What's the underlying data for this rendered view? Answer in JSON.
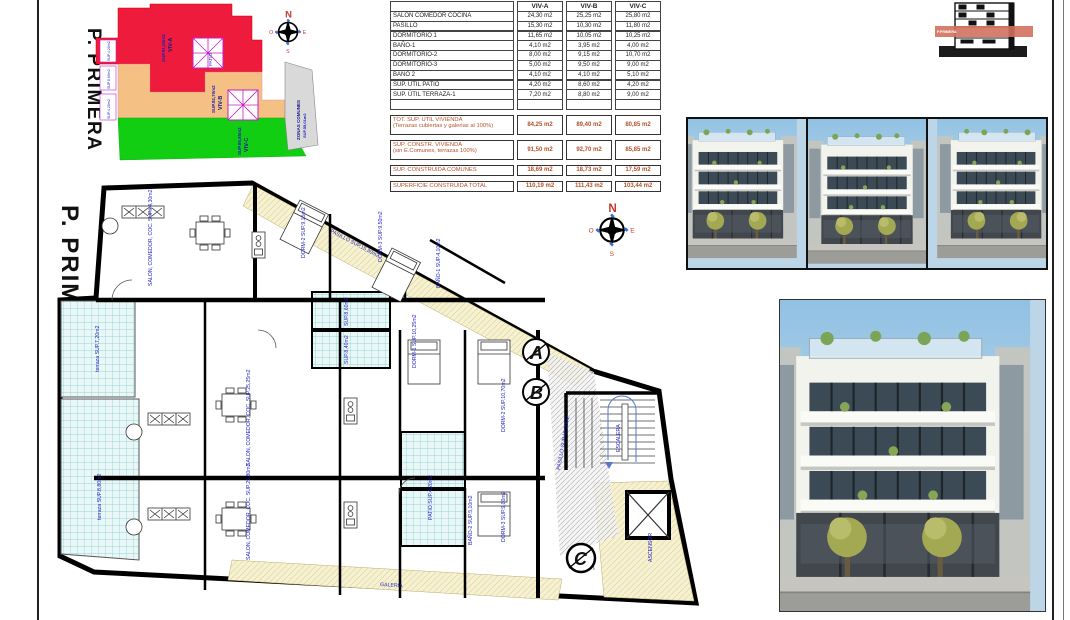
{
  "sheet": {
    "floor_title": "P. PRIMERA"
  },
  "site_plan": {
    "title": "P. PRIMERA",
    "zones": [
      {
        "name": "VIV-A",
        "area": "SUP.91,50m2",
        "color": "#ee1b3d"
      },
      {
        "name": "VIV-B",
        "area": "SUP.92,70m2",
        "color": "#f4c083"
      },
      {
        "name": "VIV-C",
        "area": "SUP.85,85m2",
        "color": "#12ce12"
      },
      {
        "name": "ZONAS COMUNES",
        "area": "SUP.55,01m2",
        "color": "#d9d9d9"
      }
    ],
    "edge_labels": [
      "SUP.4,20m2",
      "SUP.8,60m2",
      "SUP.4,20m2"
    ],
    "patio_label": "PATIO"
  },
  "compass": {
    "n": "N",
    "s": "S",
    "e": "E",
    "w": "O"
  },
  "areas_table": {
    "columns": [
      "VIV-A",
      "VIV-B",
      "VIV-C"
    ],
    "rows": [
      {
        "label": "SALON COMEDOR COCINA",
        "a": "24,30 m2",
        "b": "25,25 m2",
        "c": "25,80 m2"
      },
      {
        "label": "PASILLO",
        "a": "15,30 m2",
        "b": "10,30 m2",
        "c": "11,80 m2"
      },
      {
        "label": "DORMITORIO 1",
        "a": "11,65 m2",
        "b": "10,05 m2",
        "c": "10,25 m2"
      },
      {
        "label": "BAÑO-1",
        "a": "4,10 m2",
        "b": "3,95 m2",
        "c": "4,00 m2"
      },
      {
        "label": "DORMITORIO-2",
        "a": "8,00 m2",
        "b": "9,15 m2",
        "c": "10,70 m2"
      },
      {
        "label": "DORMITORIO-3",
        "a": "5,00 m2",
        "b": "9,50 m2",
        "c": "9,00 m2"
      },
      {
        "label": "BAÑO 2",
        "a": "4,10 m2",
        "b": "4,10 m2",
        "c": "5,10 m2"
      },
      {
        "label": "SUP. ÚTIL PATIO",
        "a": "4,20 m2",
        "b": "8,60 m2",
        "c": "4,20 m2"
      },
      {
        "label": "SUP. ÚTIL TERRAZA-1",
        "a": "7,20 m2",
        "b": "8,80 m2",
        "c": "9,00 m2"
      }
    ],
    "summary": [
      {
        "label": "TOT. SUP. UTIL VIVIENDA",
        "sub": "(Terrazas cubiertas y galerias al 100%)",
        "a": "84,25 m2",
        "b": "89,40 m2",
        "c": "80,85 m2"
      },
      {
        "label": "SUP. CONSTR. VIVIENDA",
        "sub": "(sin E.Comunes, terrazas 100%)",
        "a": "91,50 m2",
        "b": "92,70 m2",
        "c": "85,85 m2"
      },
      {
        "label": "SUP. CONSTRUIDA COMUNES",
        "sub": "",
        "a": "18,69 m2",
        "b": "18,73 m2",
        "c": "17,59 m2"
      },
      {
        "label": "SUPERFICIE CONSTRUIDA TOTAL",
        "sub": "",
        "a": "110,19 m2",
        "b": "111,43 m2",
        "c": "103,44 m2"
      }
    ]
  },
  "elevation": {
    "band_label": "P.PRIMERA"
  },
  "floor_plan": {
    "title": "P. PRIMERA",
    "section_markers": [
      "A",
      "B",
      "C"
    ],
    "room_labels": [
      "SALON, COMEDOR, COC. SUP.24,30m2",
      "PASILLO SUP.15,30m2",
      "DORM-2 SUP.9,15m2",
      "DORM-3 SUP.9,50m2",
      "BAÑO-1 SUP.4,10m2",
      "DORM-1 SUP.10,25m2",
      "SUP.8,60m2",
      "SUP.8,40m2",
      "terraza SUP.7,20m2",
      "terraza SUP.8,80m2",
      "SALON, COMEDOR, COC. SUP.25,25m2",
      "SALON, COMEDOR, COC. SUP.25,80m2",
      "DORM-2 SUP.10,70m2",
      "DORM-3 SUP.9,00m2",
      "BAÑO-2 SUP.5,10m2",
      "PATIO SUP.4,20m2",
      "PASILLO SUP.10,30m2",
      "ESCALERA",
      "ASCENSOR",
      "GALERIA"
    ],
    "wall_color": "#000000",
    "label_color": "#1f1fbf",
    "terrace_color": "#e9f7f7",
    "gallery_color": "#f6f1d3"
  }
}
